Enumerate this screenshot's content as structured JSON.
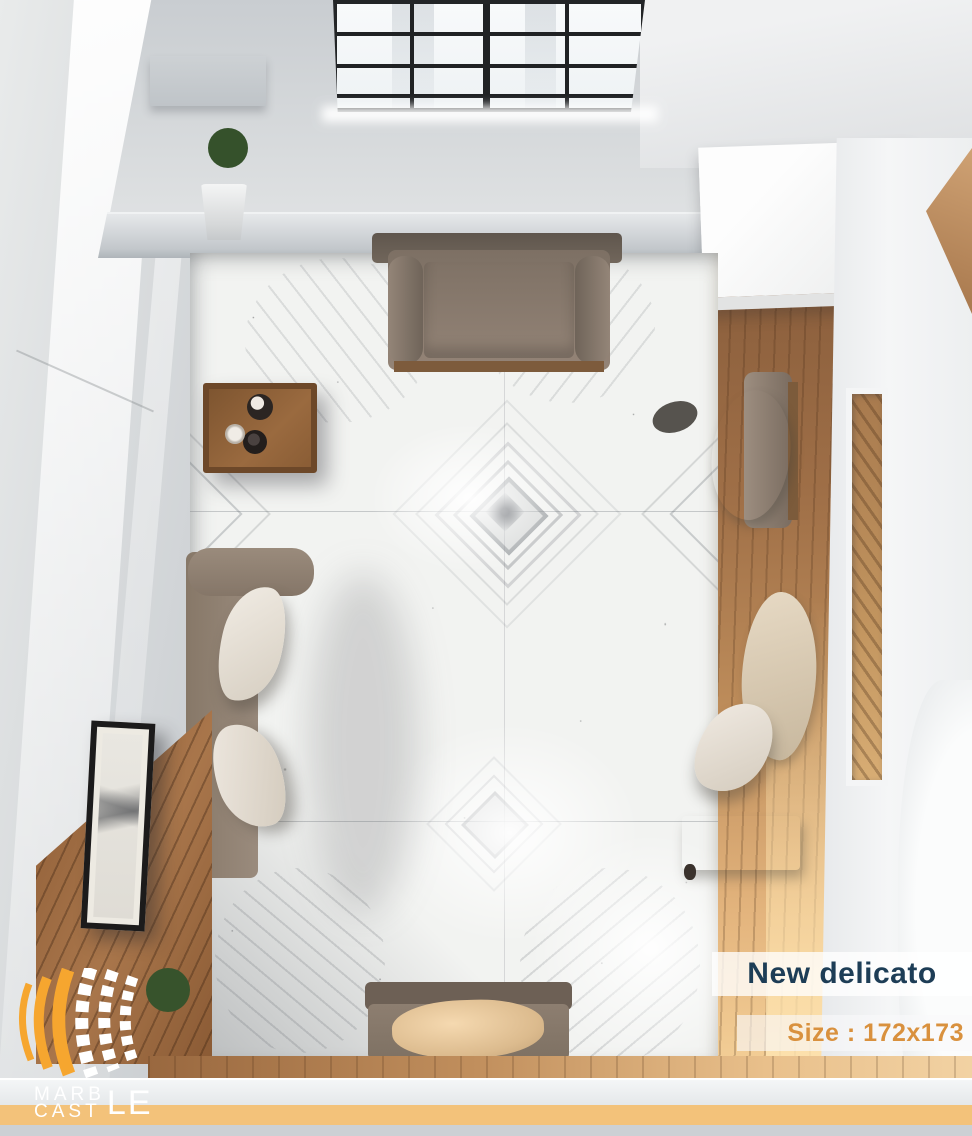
{
  "overlay": {
    "product_name": "New delicato",
    "size_label": "Size : 172x173"
  },
  "brand": {
    "name": "MARBLE CASTLE",
    "wordmark_top": "MARB",
    "wordmark_bottom": "CAST",
    "wordmark_tail": "LE",
    "logo_mark": "curved-marble-tile-stripes-icon"
  },
  "colors": {
    "product_name_text": "#1d3d56",
    "size_label_text": "#d9913e",
    "footer_band": "#f3c27a",
    "logo_orange": "#f6a62f",
    "logo_white": "#ffffff"
  }
}
